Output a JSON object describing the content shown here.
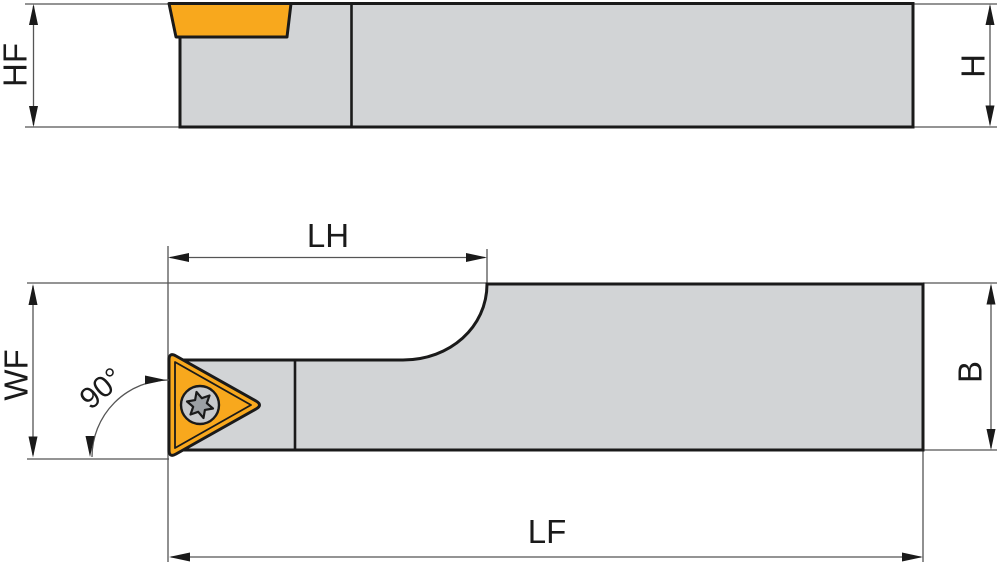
{
  "diagram": {
    "labels": {
      "hf": "HF",
      "h": "H",
      "lh": "LH",
      "wf": "WF",
      "b": "B",
      "lf": "LF",
      "angle": "90°"
    },
    "icons": {
      "insert_screw": "torx-screw-icon"
    },
    "colors": {
      "background": "#ffffff",
      "body-gray": "#d2d4d6",
      "insert-orange": "#f8a81d",
      "outline-black": "#1a1a1a",
      "dim-line": "#555555",
      "screw-outer": "#c8cacc",
      "screw-star": "#9ca0a4"
    }
  }
}
